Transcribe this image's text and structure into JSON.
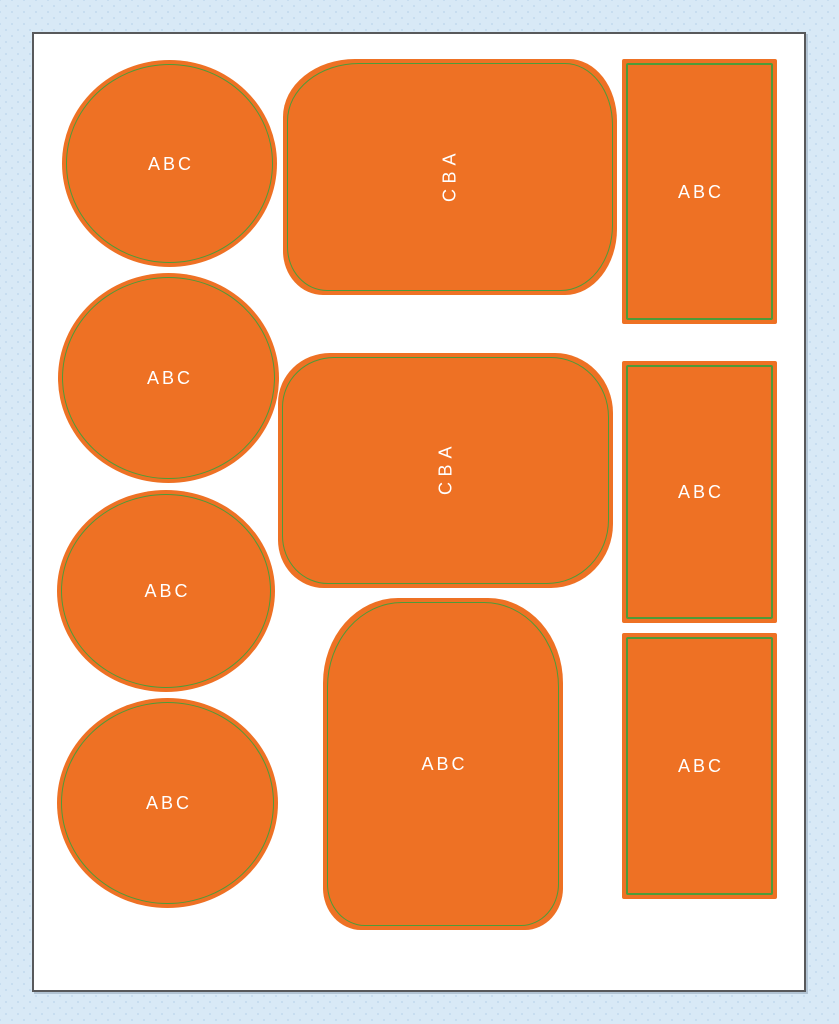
{
  "page": {
    "background_color": "#D8E9F6",
    "dot_pattern_color": "#C6DCEF",
    "sheet_fill": "#FFFFFF",
    "sheet_border_color": "#58595B"
  },
  "style": {
    "shape_fill": "#EE7124",
    "shape_outline": "#4E9B39",
    "label_color": "#FFFFFF"
  },
  "shapes": [
    {
      "id": "circle-1",
      "kind": "circle",
      "label": "ABC",
      "text_orientation": "horizontal"
    },
    {
      "id": "circle-2",
      "kind": "circle",
      "label": "ABC",
      "text_orientation": "horizontal"
    },
    {
      "id": "circle-3",
      "kind": "circle",
      "label": "ABC",
      "text_orientation": "horizontal"
    },
    {
      "id": "circle-4",
      "kind": "circle",
      "label": "ABC",
      "text_orientation": "horizontal"
    },
    {
      "id": "blob-1",
      "kind": "rounded-blob",
      "label": "ABC",
      "text_orientation": "vertical"
    },
    {
      "id": "blob-2",
      "kind": "rounded-blob",
      "label": "ABC",
      "text_orientation": "vertical"
    },
    {
      "id": "blob-3",
      "kind": "rounded-blob",
      "label": "ABC",
      "text_orientation": "horizontal"
    },
    {
      "id": "rect-1",
      "kind": "rectangle",
      "label": "ABC",
      "text_orientation": "horizontal"
    },
    {
      "id": "rect-2",
      "kind": "rectangle",
      "label": "ABC",
      "text_orientation": "horizontal"
    },
    {
      "id": "rect-3",
      "kind": "rectangle",
      "label": "ABC",
      "text_orientation": "horizontal"
    }
  ]
}
